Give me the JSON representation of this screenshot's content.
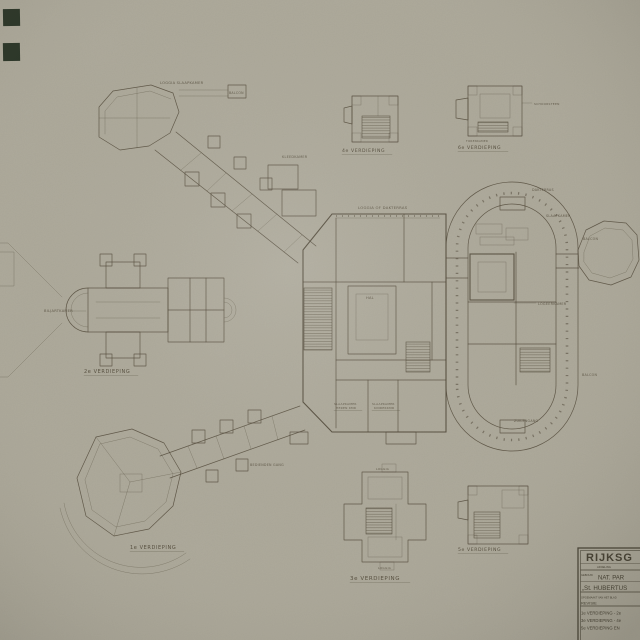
{
  "document_type": "architectural floor plan drawing",
  "colors": {
    "paper": "#b1ad9e",
    "ink": "#4e4636",
    "title_ink": "#3c3729",
    "tape_mark": "#202b1d"
  },
  "title_block": {
    "org": "RIJKSG",
    "dept": "AFDELING",
    "field1_label": "GEBOUW",
    "field1": "NAT. PAR",
    "field2": "„St. HUBERTUS",
    "note": "OPGEMAAKT VAN HET BLAD",
    "revision": "REVISIE",
    "sheet_lines": [
      "1e VERDIEPING - 2e",
      "3e VERDIEPING - 4e",
      "5e VERDIEPING EN"
    ]
  },
  "floor_labels": {
    "first": "1e VERDIEPING",
    "second": "2e VERDIEPING",
    "third": "3e VERDIEPING",
    "fourth": "4e VERDIEPING",
    "fifth": "5e VERDIEPING",
    "sixth": "6e VERDIEPING"
  },
  "room_labels": {
    "loggia_slaapkamer": "LOGGIA SLAAPKAMER",
    "balcon_nw": "BALCON",
    "kleedkamer": "KLEEDKAMER",
    "loggia_dakterras": "LOGGIA OF DAKTERRAS",
    "hal": "HAL",
    "dakterras": "DAKTERRAS",
    "slaapkamer": "SLAAPKAMER",
    "balcon_e": "BALCON",
    "logeerkamer": "LOGEERKAMER",
    "balcon_se": "BALCON",
    "zuilengang": "ZUILENGANG",
    "biljartkamer": "BILJARTKAMER",
    "bedienden_gang": "BEDIENDEN GANG",
    "slaapkamer_heren_1": "SLAAPKAMER",
    "slaapkamer_heren_2": "HEREN KMR",
    "slaapkamer_kinder_1": "SLAAPKAMER",
    "slaapkamer_kinder_2": "KINDERKMR",
    "schoorsteen": "SCHOORSTEEN",
    "torenkamer": "TORENKAMER",
    "loggia_top": "LOGGIA",
    "loggia_bottom": "LOGGIA"
  }
}
